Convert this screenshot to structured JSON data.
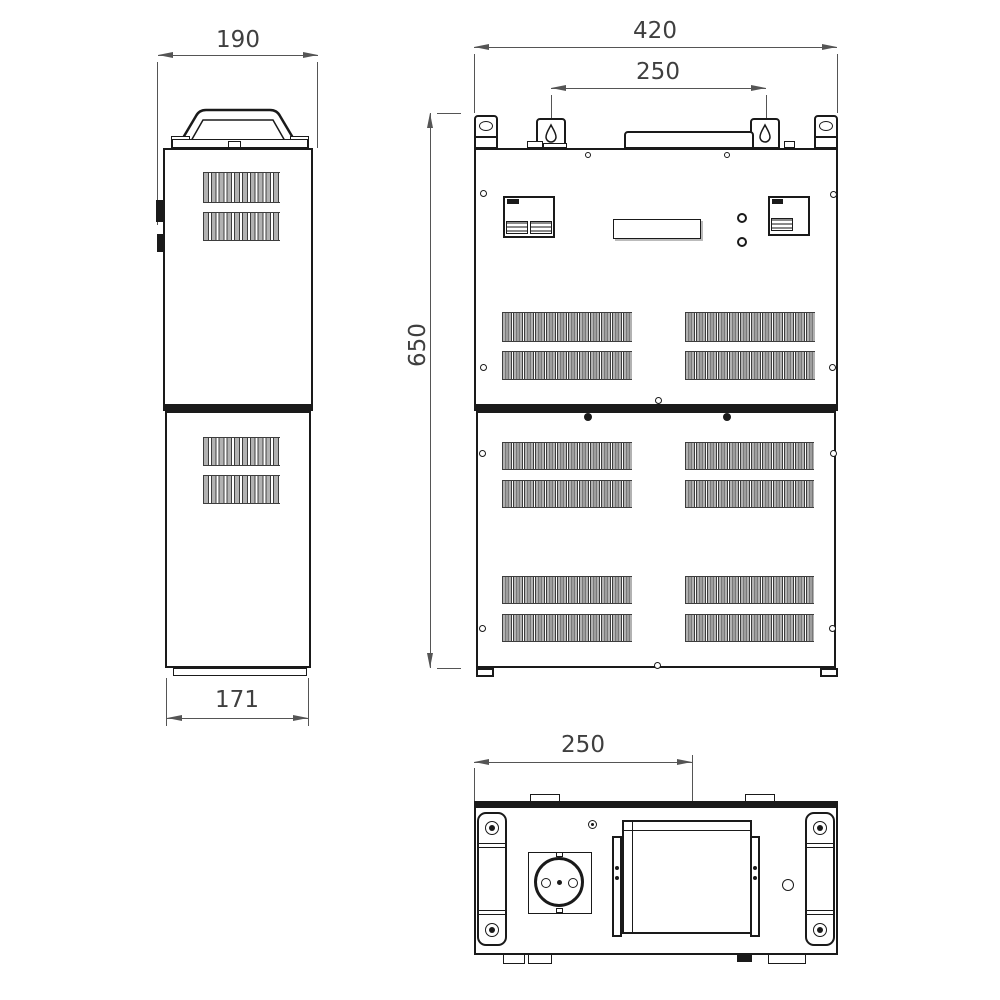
{
  "drawing": {
    "dim_labels": {
      "side_top": "190",
      "side_bottom": "171",
      "front_width": "420",
      "front_mount_spacing": "250",
      "front_height": "650",
      "bottom_offset": "250"
    },
    "colors": {
      "line": "#1a1a1a",
      "dimension": "#555555",
      "vent_fill": "#b2b2b2",
      "background": "#ffffff"
    }
  }
}
